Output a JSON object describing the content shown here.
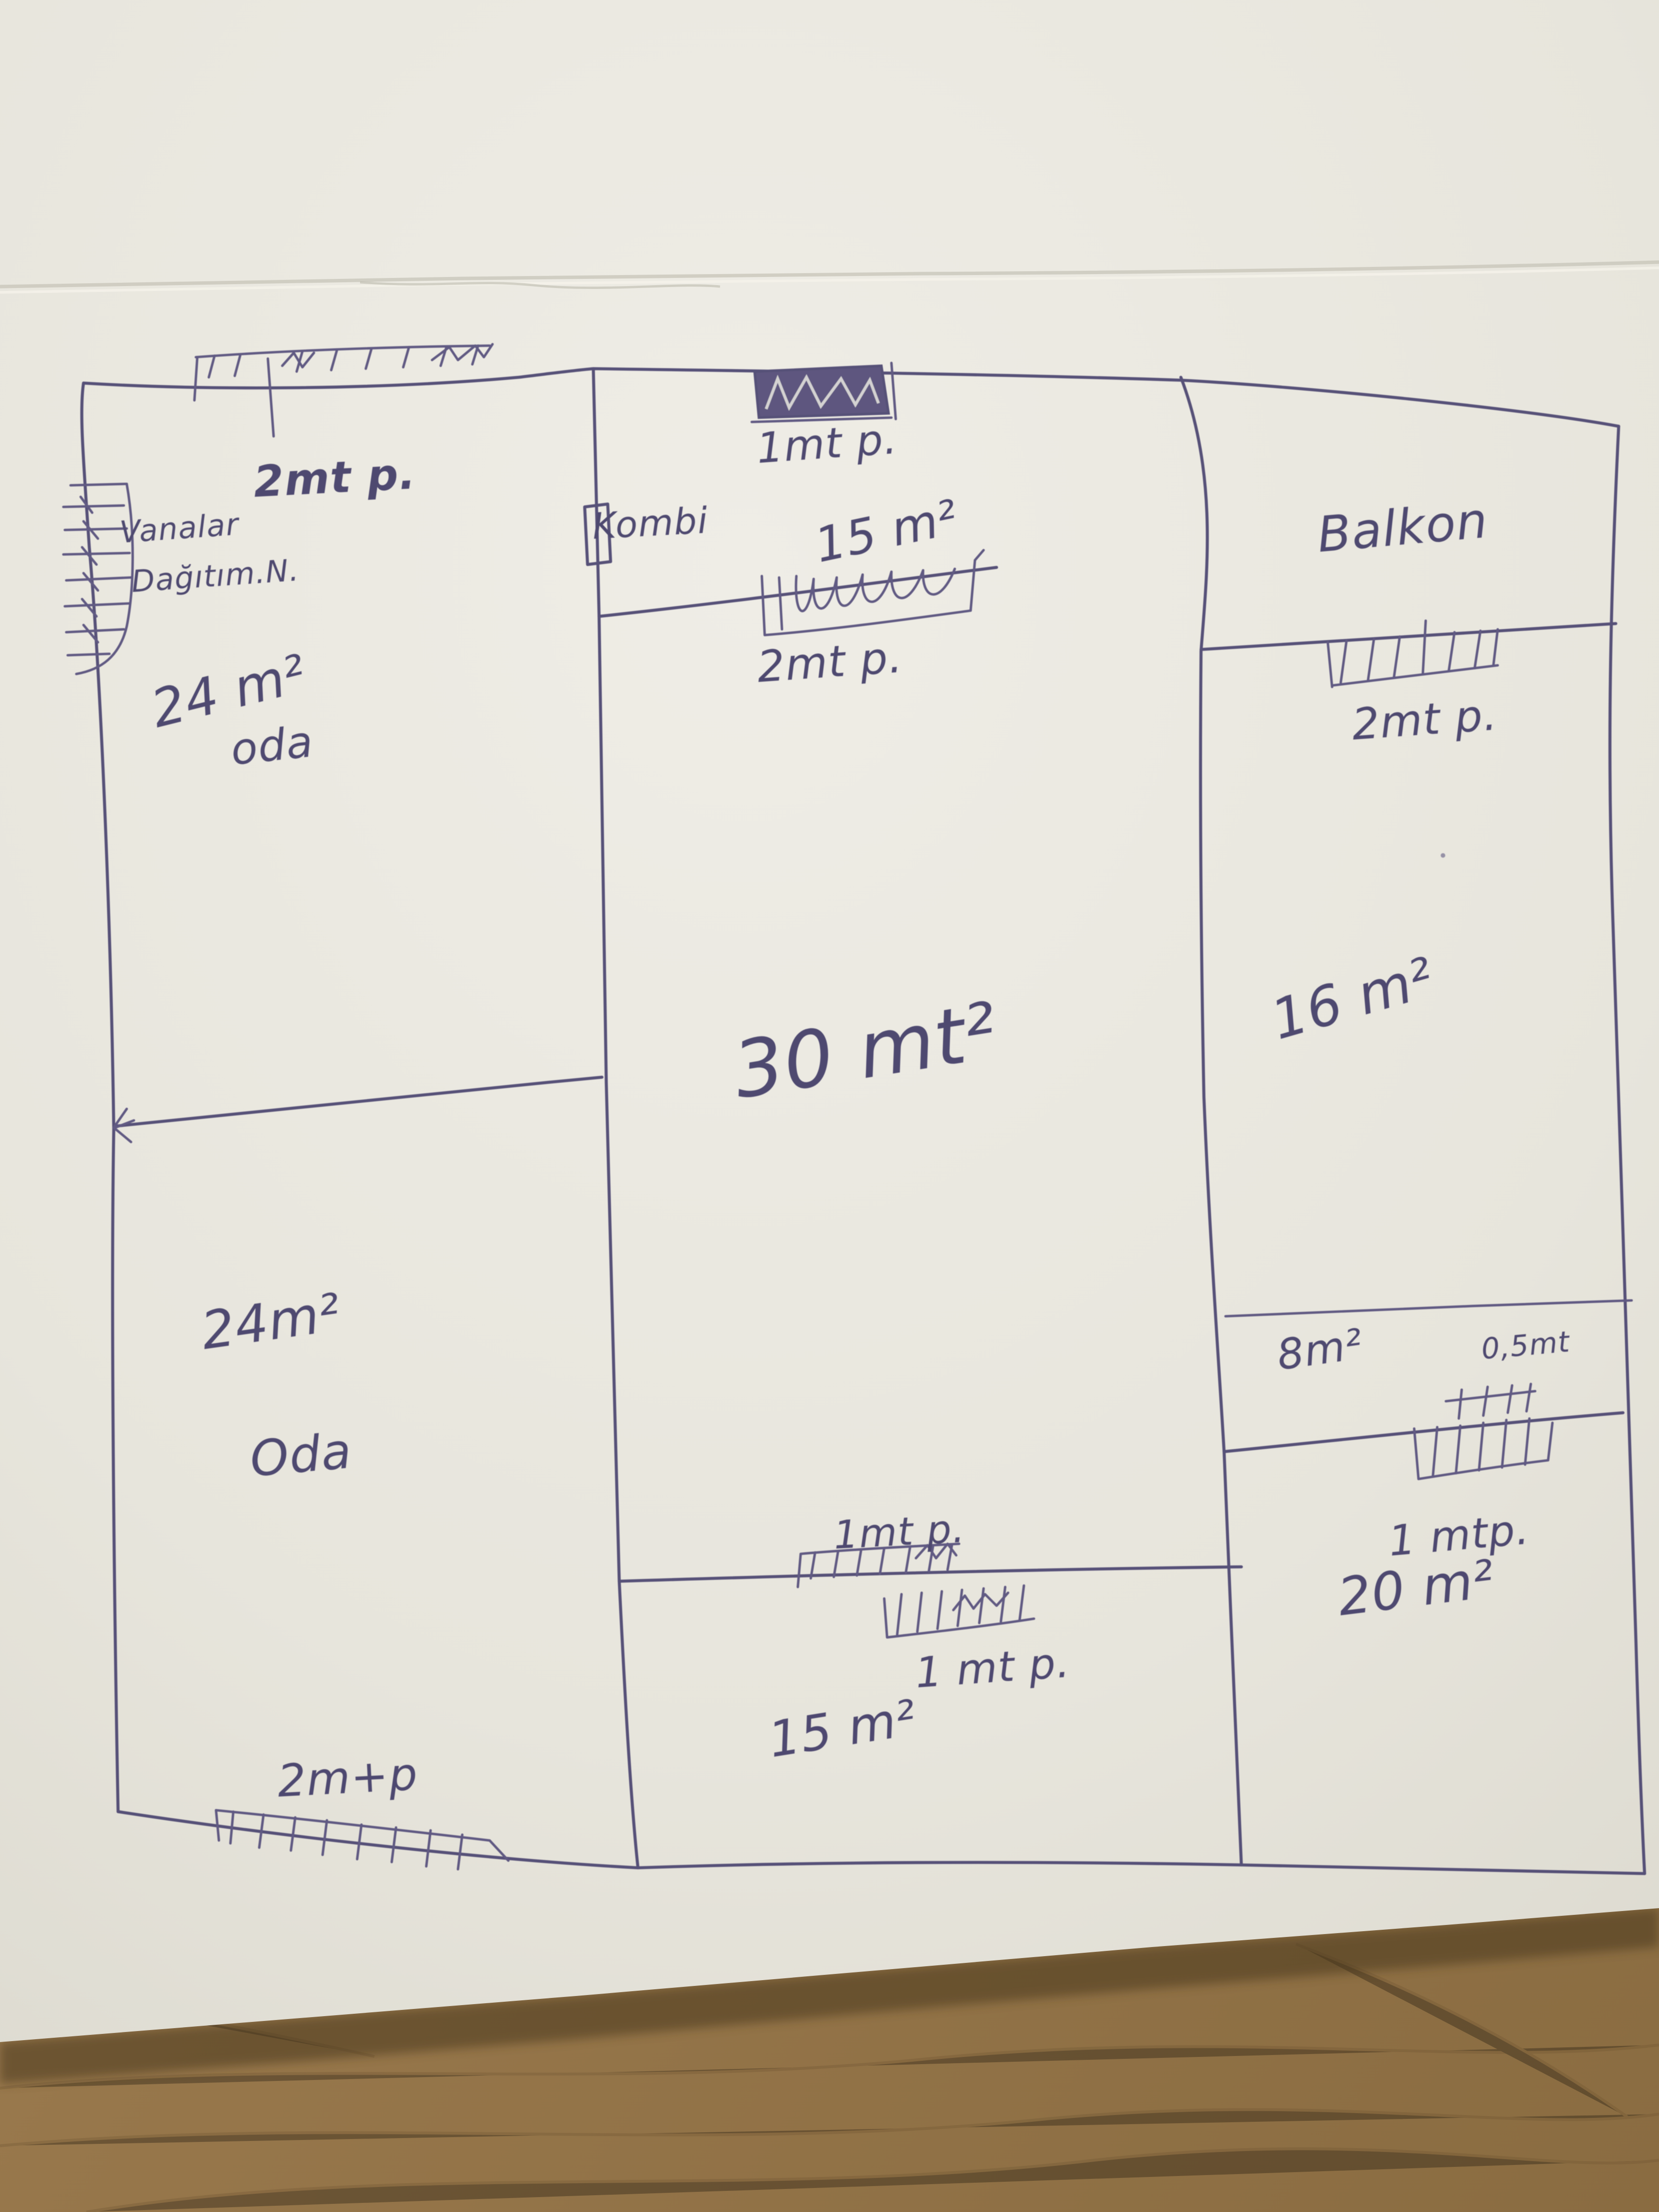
{
  "document": {
    "kind": "hand-drawn floor plan sketch",
    "medium": "blue ballpoint pen on white paper photographed on a wooden desk",
    "ink_color": "#4b4570",
    "paper_color": "#e9e7df",
    "desk_color": "#8f7147"
  },
  "labels": {
    "win_top_left": "2mt p.",
    "valves_line1": "Vanalar",
    "valves_line2": "Dağıtım.N.",
    "room_tl_area": "24 m²",
    "room_tl_name": "oda",
    "win_top_mid": "1mt p.",
    "room_tm_area": "15 m²",
    "kombi": "Kombi",
    "win_mid": "2mt p.",
    "balkon": "Balkon",
    "win_right_top": "2mt p.",
    "room_right_area": "16 m²",
    "room_center_area": "30 mt²",
    "room_bl_area": "24m²",
    "room_bl_name": "Oda",
    "strip_area": "8m²",
    "strip_note": "0,5mt",
    "win_strip": "1 mtp.",
    "room_br_area": "20 m²",
    "win_bc_upper": "1mt p.",
    "win_bc_lower": "1 mt p.",
    "room_bm_area": "15 m²",
    "win_bottom": "2m+p"
  },
  "rooms": [
    {
      "name": "oda",
      "area": "24 m²",
      "position": "top-left"
    },
    {
      "name": "Oda",
      "area": "24m²",
      "position": "bottom-left"
    },
    {
      "name": "",
      "area": "15 m²",
      "position": "top-middle"
    },
    {
      "name": "",
      "area": "30 mt²",
      "position": "center"
    },
    {
      "name": "",
      "area": "15 m²",
      "position": "bottom-middle"
    },
    {
      "name": "Balkon",
      "area": "",
      "position": "top-right"
    },
    {
      "name": "",
      "area": "16 m²",
      "position": "right-middle"
    },
    {
      "name": "",
      "area": "8m²",
      "position": "right-strip",
      "note": "0,5mt"
    },
    {
      "name": "",
      "area": "20 m²",
      "position": "bottom-right"
    }
  ],
  "fixtures": [
    {
      "id": "kombi",
      "label": "Kombi"
    },
    {
      "id": "valve-manifold",
      "label": "Vanalar Dağıtım.N."
    }
  ]
}
